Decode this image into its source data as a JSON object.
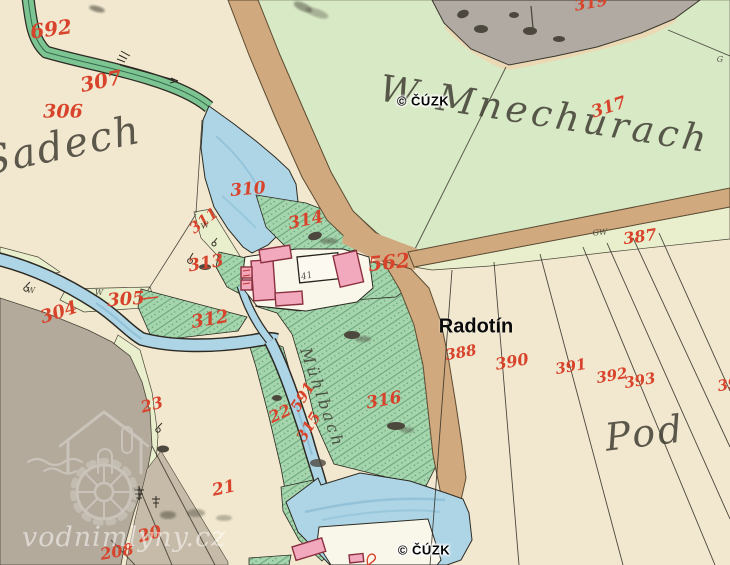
{
  "overlays": {
    "cuzk_top": "© ČÚZK",
    "cuzk_bottom": "© ČÚZK",
    "radotin": "Radotín",
    "vodnimlyny": "vodnimlyny.cz"
  },
  "place_names": [
    {
      "name": "w-mnechurach",
      "text": "W Mnechurach",
      "x": 545,
      "y": 114,
      "size": 37,
      "rot": 9,
      "spacing": 4
    },
    {
      "name": "sadech",
      "text": "Sadech",
      "x": 62,
      "y": 146,
      "size": 40,
      "rot": -12,
      "spacing": 2
    },
    {
      "name": "pod",
      "text": "Pod",
      "x": 645,
      "y": 433,
      "size": 38,
      "rot": -7,
      "spacing": 3
    },
    {
      "name": "muhlbach",
      "text": "Mühlbach",
      "x": 322,
      "y": 398,
      "size": 16,
      "rot": 71,
      "spacing": 3
    }
  ],
  "parcel_numbers": [
    {
      "text": "692",
      "x": 51,
      "y": 29,
      "size": 20,
      "rot": -8
    },
    {
      "text": "307",
      "x": 101,
      "y": 81,
      "size": 20,
      "rot": -12
    },
    {
      "text": "306",
      "x": 63,
      "y": 112,
      "size": 19,
      "rot": 0
    },
    {
      "text": "310",
      "x": 248,
      "y": 190,
      "size": 17,
      "rot": -5
    },
    {
      "text": "311",
      "x": 204,
      "y": 221,
      "size": 15,
      "rot": -38
    },
    {
      "text": "313",
      "x": 206,
      "y": 264,
      "size": 17,
      "rot": -10
    },
    {
      "text": "314",
      "x": 306,
      "y": 221,
      "size": 17,
      "rot": -12
    },
    {
      "text": "305",
      "x": 126,
      "y": 300,
      "size": 18,
      "rot": -4
    },
    {
      "text": "304",
      "x": 59,
      "y": 313,
      "size": 18,
      "rot": -18
    },
    {
      "text": "312",
      "x": 210,
      "y": 320,
      "size": 18,
      "rot": -10
    },
    {
      "text": "562",
      "x": 389,
      "y": 262,
      "size": 20,
      "rot": -6
    },
    {
      "text": "317",
      "x": 609,
      "y": 108,
      "size": 17,
      "rot": -18
    },
    {
      "text": "319",
      "x": 591,
      "y": 3,
      "size": 16,
      "rot": -10
    },
    {
      "text": "387",
      "x": 640,
      "y": 237,
      "size": 16,
      "rot": -8
    },
    {
      "text": "388",
      "x": 461,
      "y": 353,
      "size": 15,
      "rot": -10
    },
    {
      "text": "390",
      "x": 512,
      "y": 362,
      "size": 16,
      "rot": -10
    },
    {
      "text": "391",
      "x": 571,
      "y": 367,
      "size": 15,
      "rot": -10
    },
    {
      "text": "392",
      "x": 612,
      "y": 376,
      "size": 15,
      "rot": -10
    },
    {
      "text": "393",
      "x": 640,
      "y": 381,
      "size": 15,
      "rot": -10
    },
    {
      "text": "39",
      "x": 728,
      "y": 385,
      "size": 15,
      "rot": -10
    },
    {
      "text": "316",
      "x": 384,
      "y": 401,
      "size": 17,
      "rot": -10
    },
    {
      "text": "591",
      "x": 303,
      "y": 397,
      "size": 15,
      "rot": -58
    },
    {
      "text": "315",
      "x": 309,
      "y": 427,
      "size": 15,
      "rot": -58
    },
    {
      "text": "22",
      "x": 280,
      "y": 414,
      "size": 16,
      "rot": -25
    },
    {
      "text": "23",
      "x": 152,
      "y": 405,
      "size": 16,
      "rot": -15
    },
    {
      "text": "21",
      "x": 224,
      "y": 489,
      "size": 17,
      "rot": -12
    },
    {
      "text": "20",
      "x": 150,
      "y": 535,
      "size": 17,
      "rot": -15
    },
    {
      "text": "208",
      "x": 117,
      "y": 552,
      "size": 16,
      "rot": -10
    }
  ],
  "small_labels": [
    {
      "text": "41",
      "x": 307,
      "y": 277,
      "size": 9,
      "rot": -14
    },
    {
      "text": "GW",
      "x": 600,
      "y": 233,
      "size": 8,
      "rot": -5
    },
    {
      "text": "G",
      "x": 720,
      "y": 60,
      "size": 8,
      "rot": 0
    },
    {
      "text": "W",
      "x": 31,
      "y": 291,
      "size": 8,
      "rot": 0
    },
    {
      "text": "W",
      "x": 99,
      "y": 293,
      "size": 8,
      "rot": 0
    },
    {
      "text": "W",
      "x": 205,
      "y": 226,
      "size": 8,
      "rot": -20
    }
  ],
  "colors": {
    "paper": "#f2e8cf",
    "meadow": "#d8e9c5",
    "meadow_pale": "#e9efcd",
    "hatch_base": "#a5d5ad",
    "hatch_line": "#5f9c71",
    "water": "#aed5e6",
    "water_deep": "#84b9d2",
    "stream_green": "#7cc492",
    "road": "#d0a97e",
    "gray": "#b3aa9c",
    "gray_warm": "#c6bba8",
    "gray_top": "#b1aaa2",
    "pink": "#f2a9bd",
    "pink_edge": "#8a2f3e",
    "white_bldg": "#f9f6ea",
    "ink": "#2c2a22",
    "red": "#d8432c"
  }
}
